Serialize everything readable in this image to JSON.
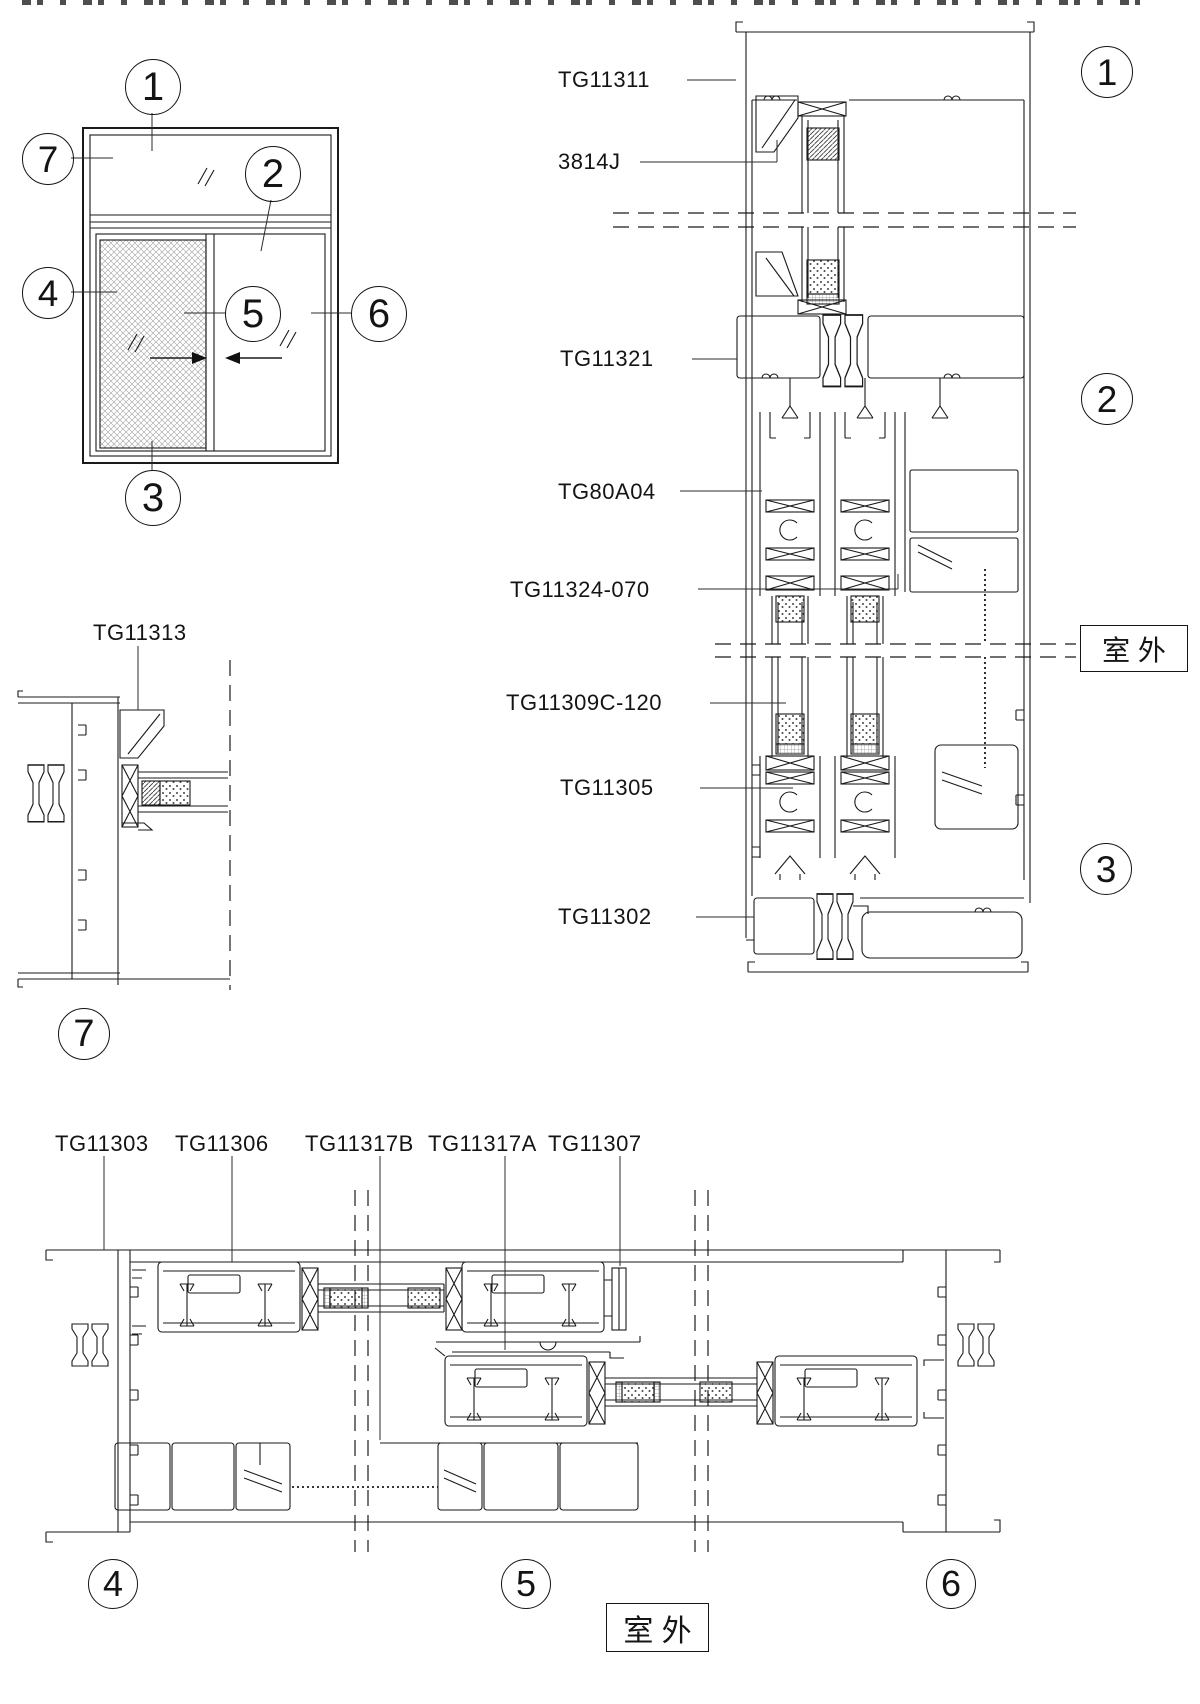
{
  "elevation": {
    "balloons": {
      "b1": "1",
      "b2": "2",
      "b3": "3",
      "b4": "4",
      "b5": "5",
      "b6": "6",
      "b7": "7"
    }
  },
  "vertical_section": {
    "part_labels": {
      "head_frame": "TG11311",
      "glazing_bead": "3814J",
      "transom": "TG11321",
      "track": "TG80A04",
      "filler": "TG11324-070",
      "sash_profile": "TG11309C-120",
      "bottom_rail": "TG11305",
      "sill": "TG11302"
    },
    "balloons": {
      "b1": "1",
      "b2": "2",
      "b3": "3"
    },
    "outdoor_label": "室 外"
  },
  "detail_7": {
    "part_label": "TG11313",
    "balloon": "7"
  },
  "horizontal_section": {
    "part_labels": {
      "jamb": "TG11303",
      "sash": "TG11306",
      "interlock_b": "TG11317B",
      "interlock_a": "TG11317A",
      "bead": "TG11307"
    },
    "balloons": {
      "b4": "4",
      "b5": "5",
      "b6": "6"
    },
    "outdoor_label": "室 外"
  }
}
